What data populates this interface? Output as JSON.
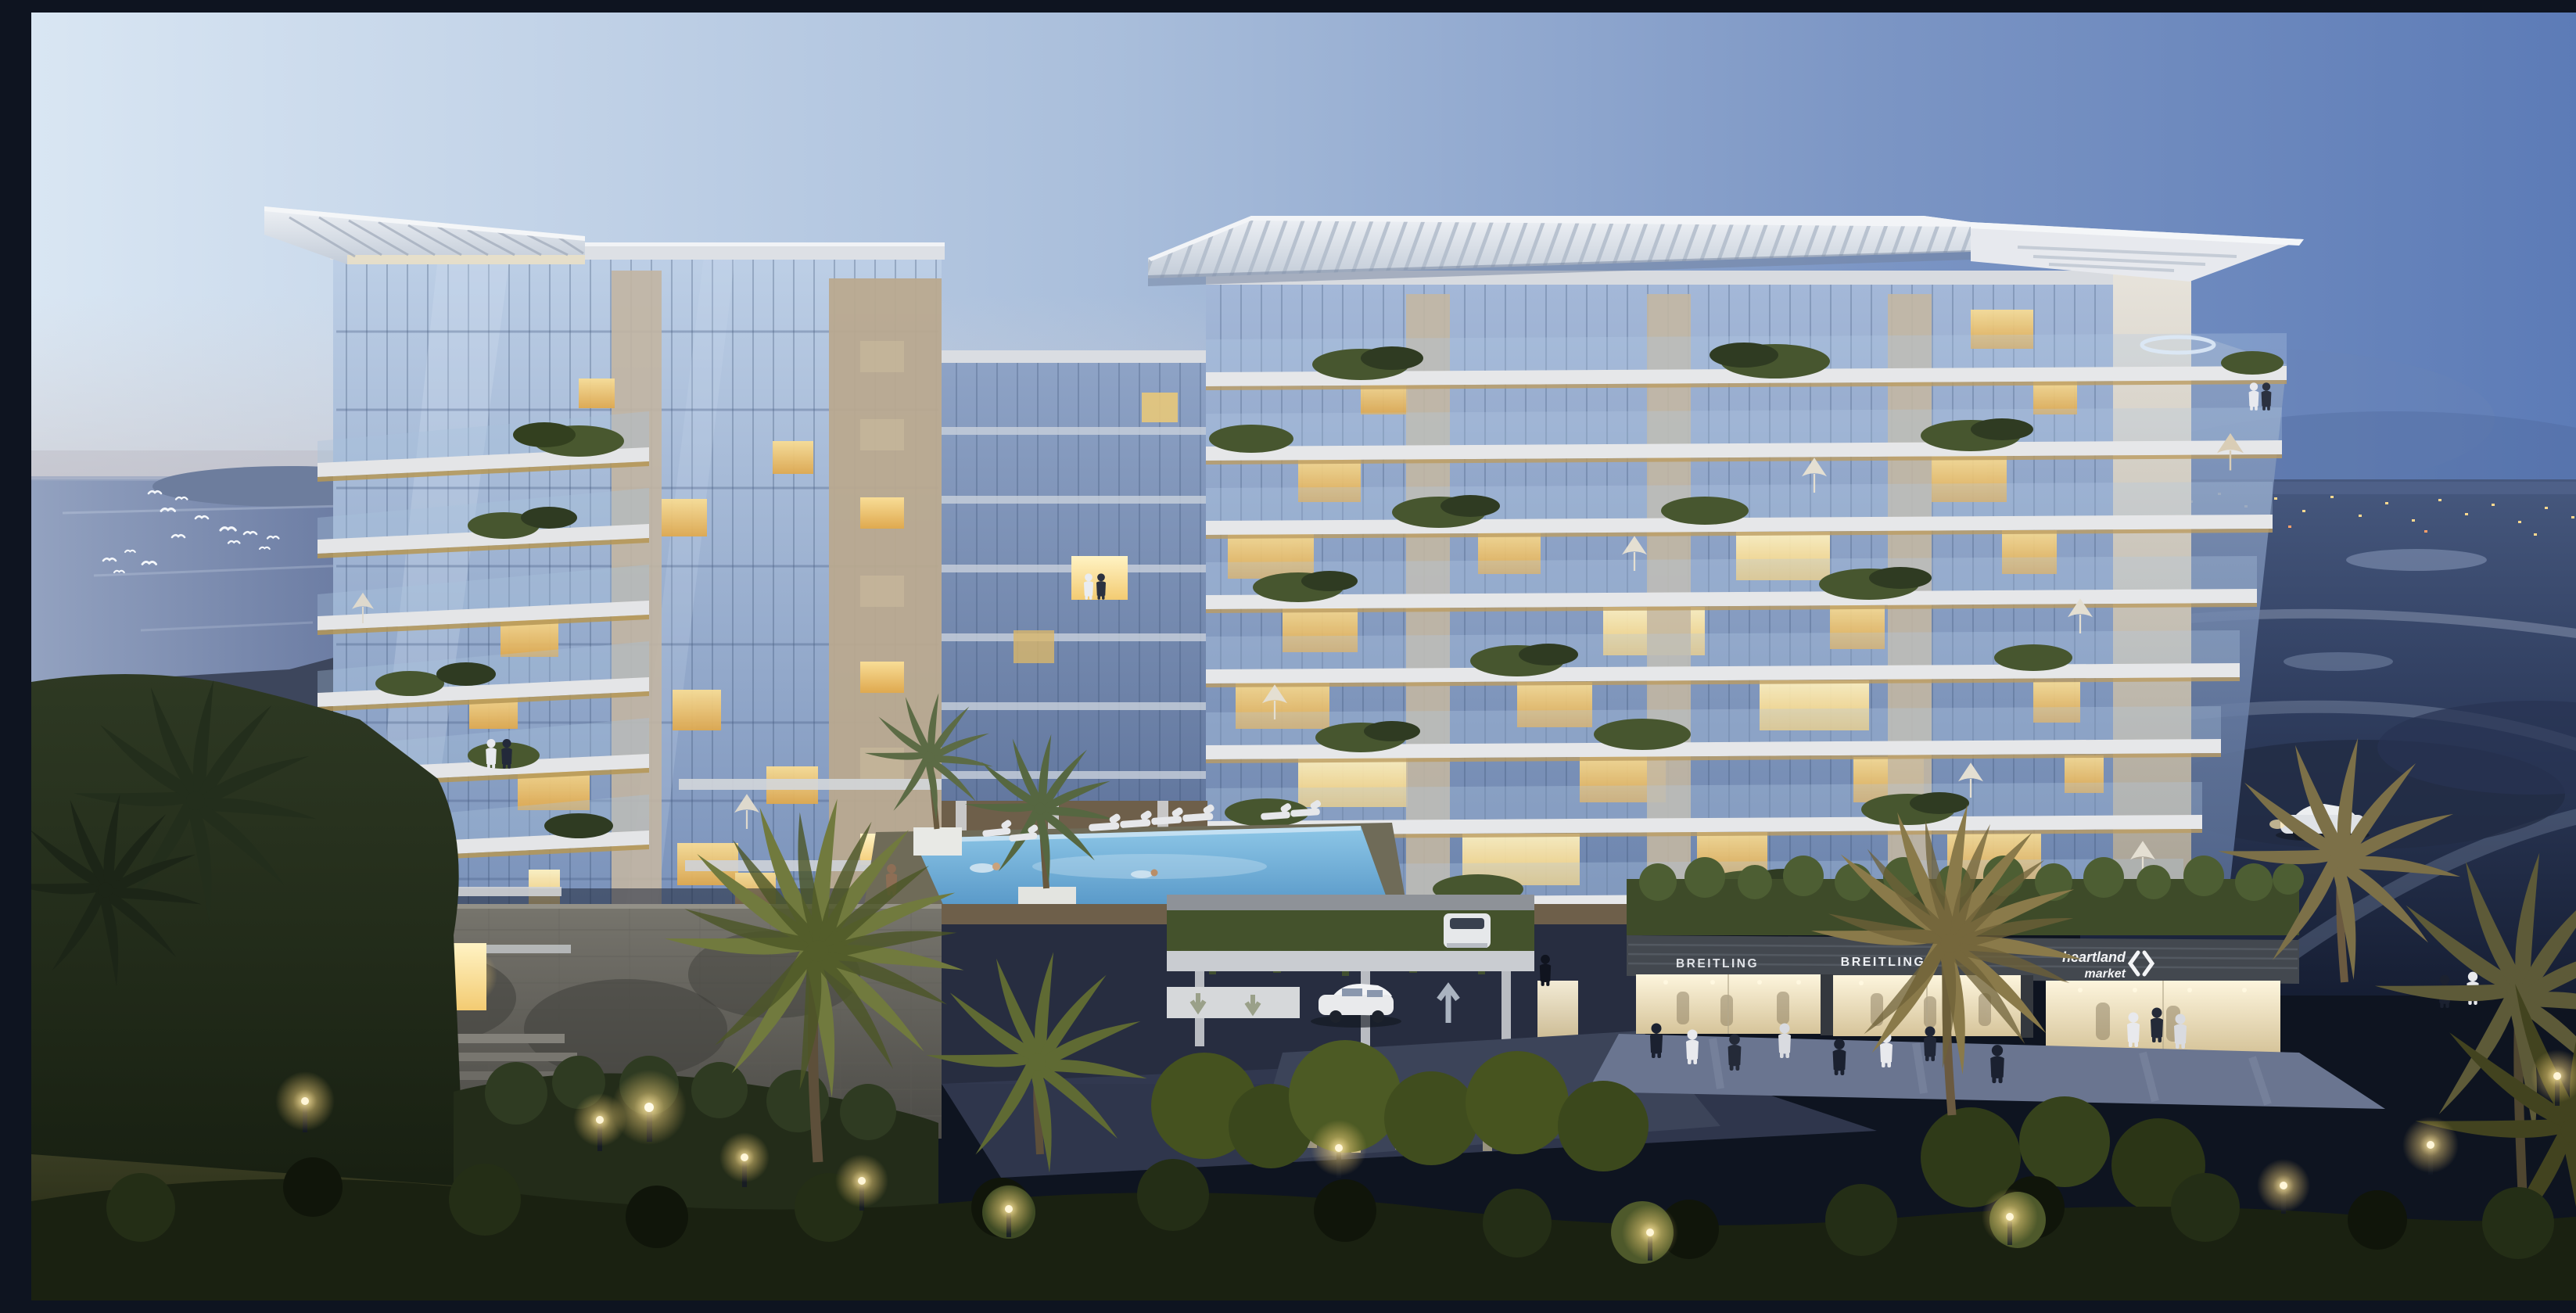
{
  "signs": {
    "breitling_store_left": "BREITLING",
    "breitling_store_right": "BREITLING",
    "market_line1": "heartland",
    "market_line2": "market"
  },
  "colors": {
    "sky_left": "#d9e6f3",
    "sky_right": "#5b7ab6",
    "horizon_haze": "#c3bcc0",
    "lagoon_water": "#66779f",
    "dusk_terrain": "#2f3d5e",
    "city_lights": "#ffd98f",
    "tower_glass": "#9db4d6",
    "deep_glass": "#6c84ad",
    "concrete_light": "#e6e7e9",
    "soffit_gold": "#bb9c62",
    "stone_tan": "#c4b7a2",
    "warm_window": "#f0cd7d",
    "hot_window": "#fff0bb",
    "pool_water": "#6fa9d6",
    "waterfall": "#cfe6f5",
    "storefront_glow": "#f6ecd2",
    "sign_text": "#f2f3f5",
    "foliage_dark": "#232e1c",
    "foliage_lit": "#6d7a3e",
    "palm_lit": "#8a7a4a",
    "lamp_glow": "#ffe9ad",
    "podium_stone": "#6b6a64",
    "road_surface": "#323950"
  }
}
